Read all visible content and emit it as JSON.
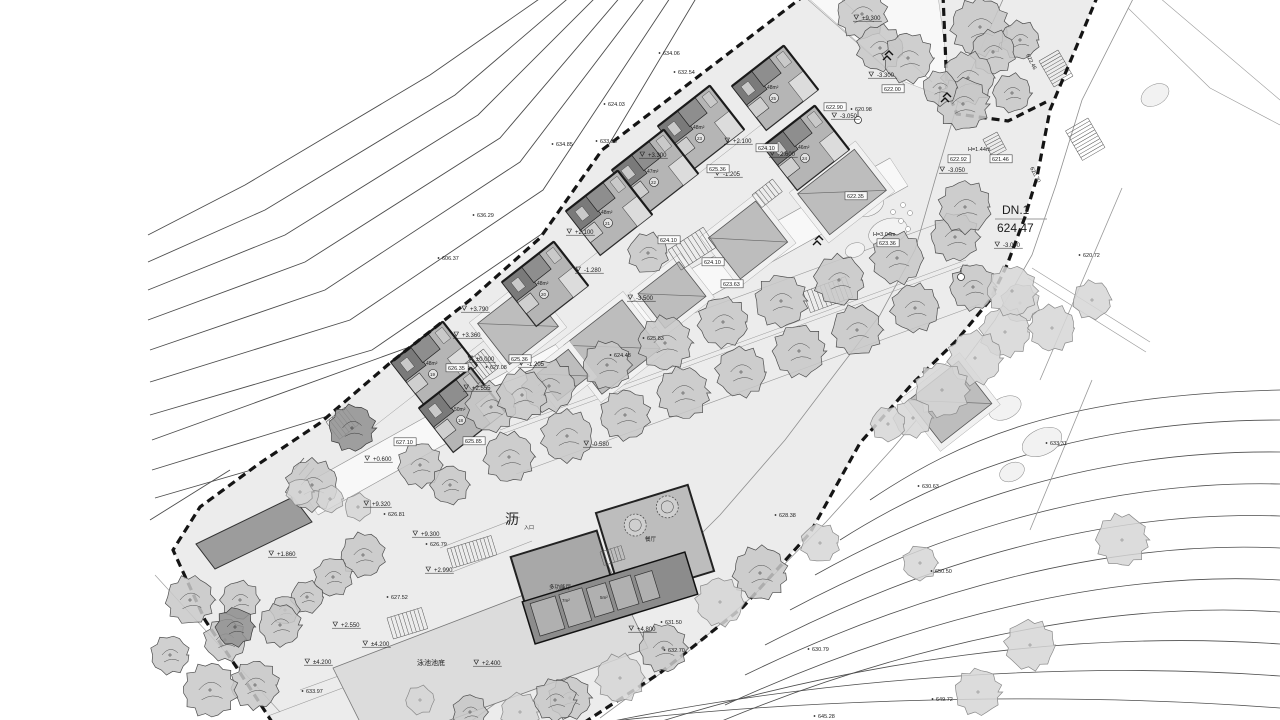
{
  "meta": {
    "drawing_type": "site-plan",
    "canvas": {
      "w": 1280,
      "h": 720
    }
  },
  "palette": {
    "paper": "#ffffff",
    "site": "#ececec",
    "road_edge": "#8f8f8f",
    "contour": "#4d4d4d",
    "boundary": "#151515",
    "villa_fill": "#b5b5b5",
    "villa_dark": "#7a7a7a",
    "villa_wall": "#1a1a1a",
    "roof_fill": "#bdbdbd",
    "pad_fill": "#f1f1f1",
    "tree_fill": "#c8c8c8",
    "tree_simple": "#d6d6d6",
    "tree_dark": "#909090",
    "pool_fill": "#dcdcdc",
    "club_left": "#a8a8a8",
    "club_right": "#bdbdbd",
    "club_wing": "#8c8c8c",
    "equip_fill": "#9c9c9c",
    "text": "#1c1c1c"
  },
  "site": {
    "poly": "805,-5 602,150 540,238 470,300 390,363 320,423 260,463 200,507 173,550 205,620 235,665 272,722 585,722 660,673 743,607 810,533 860,443 913,383 957,340 990,300 1007,265 1025,217 1050,110 1098,-5"
  },
  "white_patches": [
    {
      "poly": "300,487 890,158 908,186 318,515",
      "name": "internal-road"
    },
    {
      "poly": "806,-4 938,-4 952,100 900,80",
      "name": "upper-path"
    }
  ],
  "boundary": {
    "west": "805,-5 602,150 540,238 470,300 390,363 320,423 260,463 200,507 173,550 205,620 235,665 272,722",
    "east": "1098,-5 1050,110 1037,177 1025,217 1007,265 990,300 957,340 913,383 860,443 810,533 743,607 660,673 585,722",
    "tree_loop": "943,-5 947,90 957,114 1008,121 1046,102"
  },
  "contours_ul": [
    "545,-5 430,75 245,185 148,235",
    "572,-5 455,95 265,210 148,262",
    "598,-5 478,115 285,235 148,290",
    "622,-5 500,138 305,262 148,320",
    "647,-5 520,162 325,290 150,350",
    "672,-5 543,190 350,320 150,382",
    "698,-5 565,218 372,350 150,415",
    "530,252 415,345 152,440",
    "490,308 380,400 152,470",
    "430,372 320,450 155,498",
    "230,470 150,520"
  ],
  "contours_lr": [
    "M870,500 C960,440 1060,395 1280,390",
    "M840,540 C950,470 1090,420 1280,420",
    "M815,575 C950,500 1100,450 1280,452",
    "M790,610 C940,530 1110,480 1280,484",
    "M765,645 C930,560 1110,510 1280,516",
    "M745,675 C920,590 1110,540 1280,548",
    "M725,705 C910,620 1110,570 1280,580",
    "M705,728 C900,645 1110,600 1280,612",
    "M640,728 C850,660 1080,630 1280,644",
    "M580,728 C800,680 1060,660 1280,676",
    "M560,728 C760,700 1040,690 1280,708"
  ],
  "road": {
    "left_edge": "1005,-5 960,95 935,180 915,250 880,315 838,370 785,440 720,515 650,585 575,650 500,700 470,722",
    "right_edge": "1135,-5 1082,100 1056,185 1032,255 995,320 950,380 893,448 826,522 754,595 676,662 600,718"
  },
  "extra_lines": [
    {
      "pts": "300,487 890,158",
      "w": 0.6
    },
    {
      "pts": "318,515 908,186",
      "w": 0.6
    },
    {
      "pts": "484,390 948,220",
      "w": 0.6
    },
    {
      "pts": "516,474 980,304",
      "w": 0.6
    },
    {
      "pts": "500,430 966,260",
      "w": 0.5
    },
    {
      "pts": "502,434 968,264",
      "w": 0.5
    },
    {
      "pts": "372,428 802,93",
      "w": 0.5
    },
    {
      "pts": "1122,188 1040,380",
      "w": 0.8
    },
    {
      "pts": "1092,380 1030,530",
      "w": 0.8
    },
    {
      "pts": "1032,268 1150,342",
      "w": 0.6
    },
    {
      "pts": "1028,278 1146,352",
      "w": 0.6
    },
    {
      "pts": "1128,8 1210,88",
      "w": 0.6
    },
    {
      "pts": "1160,-2 1280,100",
      "w": 0.6
    },
    {
      "pts": "1210,88 1280,125",
      "w": 0.6
    },
    {
      "pts": "806,-2 905,85",
      "w": 0.6
    },
    {
      "pts": "840,-2 932,82",
      "w": 0.6
    },
    {
      "pts": "300,690 622,573",
      "w": 0.6
    },
    {
      "pts": "268,716 598,592",
      "w": 0.6
    },
    {
      "pts": "440,548 520,517",
      "w": 0.6
    },
    {
      "pts": "452,572 532,541",
      "w": 0.6
    },
    {
      "pts": "155,575 280,712",
      "w": 0.6
    },
    {
      "pts": "995,219 1047,219",
      "w": 1.0
    }
  ],
  "blobs": [
    {
      "cx": 868,
      "cy": 205,
      "rx": 16,
      "ry": 11,
      "rot": -20
    },
    {
      "cx": 888,
      "cy": 232,
      "rx": 20,
      "ry": 13,
      "rot": -20
    },
    {
      "cx": 855,
      "cy": 250,
      "rx": 10,
      "ry": 7,
      "rot": -20
    },
    {
      "cx": 1005,
      "cy": 408,
      "rx": 17,
      "ry": 11,
      "rot": -25
    },
    {
      "cx": 1042,
      "cy": 442,
      "rx": 21,
      "ry": 13,
      "rot": -25
    },
    {
      "cx": 1012,
      "cy": 472,
      "rx": 13,
      "ry": 9,
      "rot": -25
    },
    {
      "cx": 1155,
      "cy": 95,
      "rx": 15,
      "ry": 10,
      "rot": -30
    }
  ],
  "stones": [
    [
      903,
      205
    ],
    [
      910,
      213
    ],
    [
      901,
      221
    ],
    [
      893,
      212
    ],
    [
      908,
      229
    ]
  ],
  "pool": {
    "poly": "333,668 607,563 648,648 373,748",
    "label_cn": "泳池池底",
    "label_lv": "+2.400"
  },
  "equipment_building": {
    "poly": "196,544 293,497 312,522 215,569"
  },
  "roofs": [
    {
      "cx": 842,
      "cy": 192,
      "w": 72,
      "h": 52,
      "rot": -38
    },
    {
      "cx": 748,
      "cy": 240,
      "w": 60,
      "h": 52,
      "rot": -38
    },
    {
      "cx": 672,
      "cy": 295,
      "w": 52,
      "h": 44,
      "rot": -38
    },
    {
      "cx": 612,
      "cy": 347,
      "w": 74,
      "h": 62,
      "rot": -38
    },
    {
      "cx": 518,
      "cy": 325,
      "w": 62,
      "h": 52,
      "rot": -38
    },
    {
      "cx": 563,
      "cy": 375,
      "w": 40,
      "h": 34,
      "rot": -38
    },
    {
      "cx": 950,
      "cy": 402,
      "w": 64,
      "h": 54,
      "rot": -38
    }
  ],
  "villas": [
    {
      "cx": 775,
      "cy": 88,
      "rot": -38,
      "area": "48m²",
      "num": "25"
    },
    {
      "cx": 806,
      "cy": 148,
      "rot": -38,
      "area": "46m²",
      "num": "24"
    },
    {
      "cx": 701,
      "cy": 128,
      "rot": -38,
      "area": "48m²",
      "num": "23"
    },
    {
      "cx": 655,
      "cy": 172,
      "rot": -38,
      "area": "47m²",
      "num": "22"
    },
    {
      "cx": 609,
      "cy": 213,
      "rot": -38,
      "area": "48m²",
      "num": "21"
    },
    {
      "cx": 545,
      "cy": 284,
      "rot": -38,
      "area": "48m²",
      "num": "20"
    },
    {
      "cx": 434,
      "cy": 364,
      "rot": -38,
      "area": "48m²",
      "num": "19"
    },
    {
      "cx": 462,
      "cy": 410,
      "rot": -38,
      "area": "50m²",
      "num": "18"
    }
  ],
  "clubhouse": {
    "left_hall": {
      "cx": 566,
      "cy": 584,
      "w": 90,
      "h": 84,
      "rot": -17,
      "label": "多功能厅"
    },
    "right_hall": {
      "cx": 655,
      "cy": 542,
      "w": 96,
      "h": 90,
      "rot": -17,
      "label": "餐厅"
    },
    "wing": {
      "cx": 610,
      "cy": 598,
      "w": 170,
      "h": 44,
      "rot": -17
    },
    "tables": [
      {
        "x": -14,
        "y": -22,
        "r": 11
      },
      {
        "x": 22,
        "y": -30,
        "r": 11
      }
    ],
    "rooms": [
      [
        -78,
        -18,
        26,
        34
      ],
      [
        -48,
        -18,
        24,
        34
      ],
      [
        -20,
        -16,
        20,
        30
      ],
      [
        4,
        -16,
        22,
        30
      ],
      [
        30,
        -14,
        18,
        28
      ]
    ],
    "room_labels": [
      {
        "x": 562,
        "y": 602,
        "t": "7m²"
      },
      {
        "x": 600,
        "y": 599,
        "t": "5m²"
      }
    ],
    "entrance_label": "入口"
  },
  "stairs": [
    {
      "x": 803,
      "y": 292,
      "len": 45,
      "wid": 22,
      "rot": -20,
      "n": 10
    },
    {
      "x": 668,
      "y": 250,
      "len": 42,
      "wid": 24,
      "rot": -33,
      "n": 9
    },
    {
      "x": 447,
      "y": 549,
      "len": 46,
      "wid": 20,
      "rot": -17,
      "n": 12
    },
    {
      "x": 387,
      "y": 618,
      "len": 36,
      "wid": 22,
      "rot": -17,
      "n": 9
    },
    {
      "x": 463,
      "y": 365,
      "len": 26,
      "wid": 24,
      "rot": -38,
      "n": 7
    },
    {
      "x": 326,
      "y": 422,
      "len": 24,
      "wid": 22,
      "rot": -38,
      "n": 6
    },
    {
      "x": 997,
      "y": 132,
      "len": 20,
      "wid": 16,
      "rot": 62,
      "n": 6
    },
    {
      "x": 600,
      "y": 552,
      "len": 22,
      "wid": 14,
      "rot": -17,
      "n": 6
    },
    {
      "x": 752,
      "y": 195,
      "len": 26,
      "wid": 16,
      "rot": -38,
      "n": 6
    },
    {
      "x": 1058,
      "y": 50,
      "len": 30,
      "wid": 22,
      "rot": 60,
      "n": 9
    },
    {
      "x": 1088,
      "y": 118,
      "len": 34,
      "wid": 26,
      "rot": 60,
      "n": 10
    }
  ],
  "trees": [
    [
      491,
      407,
      26,
      "d"
    ],
    [
      549,
      386,
      27,
      "d"
    ],
    [
      607,
      365,
      25,
      "d"
    ],
    [
      665,
      343,
      28,
      "d"
    ],
    [
      723,
      322,
      26,
      "d"
    ],
    [
      781,
      301,
      27,
      "d"
    ],
    [
      839,
      280,
      26,
      "d"
    ],
    [
      897,
      258,
      27,
      "d"
    ],
    [
      955,
      237,
      25,
      "d"
    ],
    [
      509,
      457,
      26,
      "d"
    ],
    [
      567,
      436,
      27,
      "d"
    ],
    [
      625,
      415,
      26,
      "d"
    ],
    [
      683,
      393,
      27,
      "d"
    ],
    [
      741,
      372,
      26,
      "d"
    ],
    [
      799,
      351,
      27,
      "d"
    ],
    [
      857,
      330,
      26,
      "d"
    ],
    [
      915,
      308,
      25,
      "d"
    ],
    [
      973,
      287,
      24,
      "d"
    ],
    [
      1020,
      303,
      20,
      "s"
    ],
    [
      1005,
      332,
      26,
      "s"
    ],
    [
      975,
      358,
      28,
      "s"
    ],
    [
      942,
      390,
      28,
      "s"
    ],
    [
      913,
      418,
      20,
      "s"
    ],
    [
      888,
      424,
      18,
      "s"
    ],
    [
      820,
      543,
      20,
      "s"
    ],
    [
      760,
      573,
      28,
      "d"
    ],
    [
      720,
      602,
      25,
      "s"
    ],
    [
      663,
      648,
      25,
      "d"
    ],
    [
      620,
      678,
      25,
      "s"
    ],
    [
      570,
      698,
      22,
      "d"
    ],
    [
      520,
      712,
      20,
      "s"
    ],
    [
      1122,
      540,
      27,
      "s"
    ],
    [
      1030,
      645,
      26,
      "s"
    ],
    [
      978,
      692,
      24,
      "s"
    ],
    [
      920,
      563,
      18,
      "s"
    ],
    [
      980,
      27,
      30,
      "d"
    ],
    [
      1020,
      40,
      20,
      "d"
    ],
    [
      993,
      52,
      23,
      "d"
    ],
    [
      968,
      78,
      27,
      "d"
    ],
    [
      1012,
      93,
      20,
      "d"
    ],
    [
      963,
      104,
      27,
      "d"
    ],
    [
      940,
      88,
      18,
      "d"
    ],
    [
      965,
      207,
      27,
      "d"
    ],
    [
      862,
      14,
      26,
      "d"
    ],
    [
      880,
      48,
      24,
      "d"
    ],
    [
      908,
      58,
      26,
      "d"
    ],
    [
      1012,
      291,
      26,
      "s"
    ],
    [
      1052,
      328,
      24,
      "s"
    ],
    [
      1092,
      300,
      20,
      "s"
    ],
    [
      648,
      253,
      21,
      "d"
    ],
    [
      522,
      395,
      26,
      "d"
    ],
    [
      420,
      465,
      23,
      "d"
    ],
    [
      352,
      428,
      24,
      "k"
    ],
    [
      450,
      485,
      20,
      "d"
    ],
    [
      312,
      485,
      27,
      "d"
    ],
    [
      363,
      555,
      23,
      "d"
    ],
    [
      333,
      577,
      20,
      "d"
    ],
    [
      307,
      597,
      17,
      "d"
    ],
    [
      285,
      610,
      15,
      "d"
    ],
    [
      190,
      600,
      25,
      "d"
    ],
    [
      225,
      640,
      22,
      "d"
    ],
    [
      255,
      685,
      25,
      "d"
    ],
    [
      210,
      690,
      28,
      "d"
    ],
    [
      170,
      655,
      20,
      "d"
    ],
    [
      280,
      625,
      22,
      "d"
    ],
    [
      240,
      600,
      20,
      "d"
    ],
    [
      235,
      627,
      20,
      "k"
    ],
    [
      300,
      492,
      14,
      "s"
    ],
    [
      330,
      499,
      14,
      "s"
    ],
    [
      358,
      507,
      14,
      "s"
    ],
    [
      555,
      700,
      22,
      "d"
    ],
    [
      470,
      712,
      18,
      "d"
    ],
    [
      420,
      700,
      15,
      "s"
    ]
  ],
  "manholes": [
    [
      858,
      120
    ],
    [
      961,
      277
    ]
  ],
  "birds": [
    [
      820,
      240
    ],
    [
      890,
      55
    ],
    [
      948,
      97
    ]
  ],
  "equip_text_marks": [
    "294,470 304,458",
    "299,475 309,463",
    "304,480 314,468"
  ],
  "labels": {
    "tri": [
      {
        "x": 862,
        "y": 20,
        "t": "+9.300"
      },
      {
        "x": 877,
        "y": 77,
        "t": "-3.300"
      },
      {
        "x": 840,
        "y": 118,
        "t": "-3.050"
      },
      {
        "x": 948,
        "y": 172,
        "t": "-3.050"
      },
      {
        "x": 648,
        "y": 157,
        "t": "+3.300"
      },
      {
        "x": 733,
        "y": 143,
        "t": "+2.100"
      },
      {
        "x": 575,
        "y": 234,
        "t": "+2.100"
      },
      {
        "x": 778,
        "y": 156,
        "t": "-2.600"
      },
      {
        "x": 723,
        "y": 176,
        "t": "-1.205"
      },
      {
        "x": 527,
        "y": 366,
        "t": "-1.205"
      },
      {
        "x": 584,
        "y": 272,
        "t": "-1.280"
      },
      {
        "x": 636,
        "y": 300,
        "t": "-3.500"
      },
      {
        "x": 592,
        "y": 446,
        "t": "-0.580"
      },
      {
        "x": 470,
        "y": 311,
        "t": "+3.790"
      },
      {
        "x": 462,
        "y": 337,
        "t": "+3.360"
      },
      {
        "x": 476,
        "y": 361,
        "t": "±0.000"
      },
      {
        "x": 472,
        "y": 390,
        "t": "+2.555"
      },
      {
        "x": 1003,
        "y": 247,
        "t": "-3.000"
      },
      {
        "x": 373,
        "y": 461,
        "t": "+0.600"
      },
      {
        "x": 277,
        "y": 556,
        "t": "+1.860"
      },
      {
        "x": 372,
        "y": 506,
        "t": "+9.320"
      },
      {
        "x": 421,
        "y": 536,
        "t": "+9.300"
      },
      {
        "x": 434,
        "y": 572,
        "t": "+2.990"
      },
      {
        "x": 341,
        "y": 627,
        "t": "+2.550"
      },
      {
        "x": 371,
        "y": 646,
        "t": "±4.200"
      },
      {
        "x": 313,
        "y": 664,
        "t": "±4.200"
      },
      {
        "x": 637,
        "y": 631,
        "t": "+4.800"
      },
      {
        "x": 482,
        "y": 665,
        "t": "+2.400"
      }
    ],
    "dot": [
      {
        "x": 663,
        "y": 55,
        "t": "634.06"
      },
      {
        "x": 678,
        "y": 74,
        "t": "632.54"
      },
      {
        "x": 608,
        "y": 106,
        "t": "624.03"
      },
      {
        "x": 556,
        "y": 146,
        "t": "634.85"
      },
      {
        "x": 600,
        "y": 143,
        "t": "633.98"
      },
      {
        "x": 477,
        "y": 217,
        "t": "636.29"
      },
      {
        "x": 442,
        "y": 260,
        "t": "606.37"
      },
      {
        "x": 855,
        "y": 111,
        "t": "620.98"
      },
      {
        "x": 388,
        "y": 516,
        "t": "626.81"
      },
      {
        "x": 430,
        "y": 546,
        "t": "626.79"
      },
      {
        "x": 391,
        "y": 599,
        "t": "627.52"
      },
      {
        "x": 306,
        "y": 693,
        "t": "633.97"
      },
      {
        "x": 779,
        "y": 517,
        "t": "628.38"
      },
      {
        "x": 614,
        "y": 357,
        "t": "624.48"
      },
      {
        "x": 647,
        "y": 340,
        "t": "625.83"
      },
      {
        "x": 490,
        "y": 369,
        "t": "627.08"
      },
      {
        "x": 1050,
        "y": 445,
        "t": "633.31"
      },
      {
        "x": 922,
        "y": 488,
        "t": "630.63"
      },
      {
        "x": 935,
        "y": 573,
        "t": "650.50"
      },
      {
        "x": 665,
        "y": 624,
        "t": "631.50"
      },
      {
        "x": 668,
        "y": 652,
        "t": "632.70"
      },
      {
        "x": 812,
        "y": 651,
        "t": "630.79"
      },
      {
        "x": 818,
        "y": 718,
        "t": "645.28"
      },
      {
        "x": 936,
        "y": 701,
        "t": "649.72"
      },
      {
        "x": 1083,
        "y": 257,
        "t": "620.72"
      }
    ],
    "box": [
      {
        "x": 884,
        "y": 91,
        "t": "622.00"
      },
      {
        "x": 826,
        "y": 109,
        "t": "622.90"
      },
      {
        "x": 950,
        "y": 161,
        "t": "622.92"
      },
      {
        "x": 992,
        "y": 161,
        "t": "621.46"
      },
      {
        "x": 758,
        "y": 150,
        "t": "624.10"
      },
      {
        "x": 709,
        "y": 171,
        "t": "625.36"
      },
      {
        "x": 660,
        "y": 242,
        "t": "624.10"
      },
      {
        "x": 704,
        "y": 264,
        "t": "624.10"
      },
      {
        "x": 723,
        "y": 286,
        "t": "623.63"
      },
      {
        "x": 847,
        "y": 198,
        "t": "622.35"
      },
      {
        "x": 879,
        "y": 245,
        "t": "623.36"
      },
      {
        "x": 511,
        "y": 361,
        "t": "625.36"
      },
      {
        "x": 448,
        "y": 370,
        "t": "626.35"
      },
      {
        "x": 396,
        "y": 444,
        "t": "627.10"
      },
      {
        "x": 465,
        "y": 443,
        "t": "625.85"
      }
    ],
    "plain": [
      {
        "x": 968,
        "y": 151,
        "t": "H=1.44m",
        "fs": 5.5
      },
      {
        "x": 873,
        "y": 236,
        "t": "H=3.04m",
        "fs": 5.5
      },
      {
        "x": 1002,
        "y": 214,
        "t": "DN.1",
        "fs": 12
      },
      {
        "x": 997,
        "y": 232,
        "t": "624.47",
        "fs": 12
      },
      {
        "x": 417,
        "y": 665,
        "t": "泳池池底",
        "fs": 7
      },
      {
        "x": 505,
        "y": 524,
        "t": "沥",
        "fs": 14
      },
      {
        "x": 524,
        "y": 529,
        "t": "入口",
        "fs": 5
      },
      {
        "x": 1026,
        "y": 55,
        "t": "622.46",
        "fs": 5.5,
        "rot": 63
      },
      {
        "x": 1030,
        "y": 168,
        "t": "620.70",
        "fs": 5.5,
        "rot": 63
      },
      {
        "x": 549,
        "y": 589,
        "t": "多功能厅",
        "fs": 5.5
      },
      {
        "x": 645,
        "y": 541,
        "t": "餐厅",
        "fs": 5.5
      },
      {
        "x": 562,
        "y": 602,
        "t": "7m²",
        "fs": 4.5
      },
      {
        "x": 600,
        "y": 599,
        "t": "5m²",
        "fs": 4.5
      }
    ]
  }
}
